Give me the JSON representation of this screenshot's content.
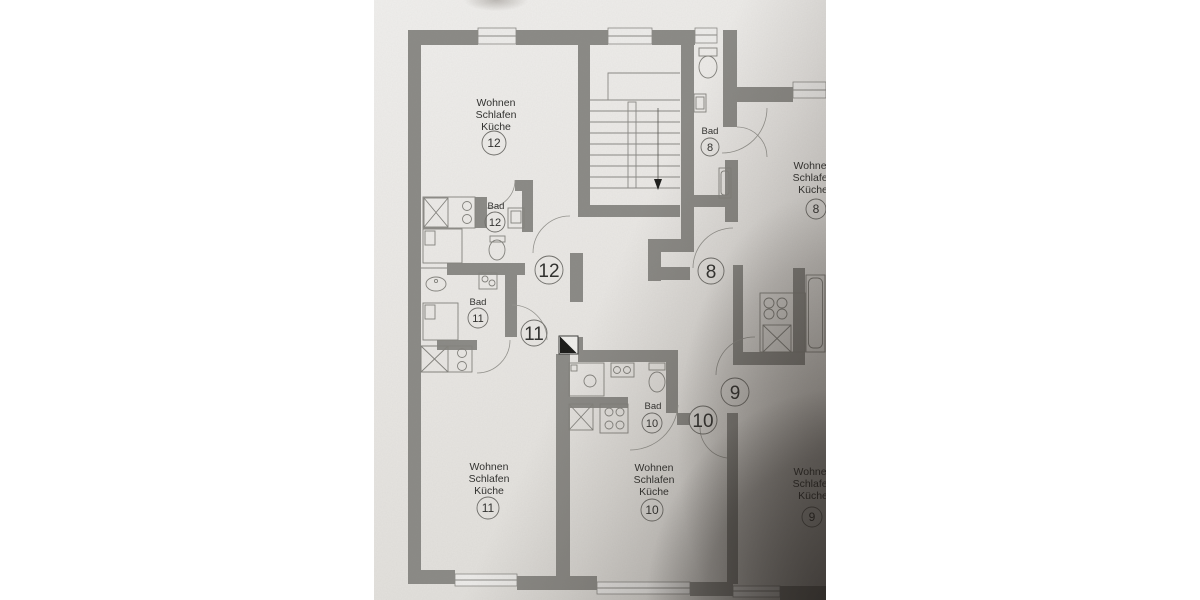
{
  "labels": {
    "apt12": {
      "line1": "Wohnen",
      "line2": "Schlafen",
      "line3": "Küche",
      "number": "12"
    },
    "apt11": {
      "line1": "Wohnen",
      "line2": "Schlafen",
      "line3": "Küche",
      "number": "11"
    },
    "apt10": {
      "line1": "Wohnen",
      "line2": "Schlafen",
      "line3": "Küche",
      "number": "10"
    },
    "apt9": {
      "line1": "Wohnen",
      "line2": "Schlafen",
      "line3": "Küche",
      "number": "9"
    },
    "apt8": {
      "line1": "Wohnen",
      "line2": "Schlafen",
      "line3": "Küche",
      "number": "8"
    },
    "bad12": {
      "name": "Bad",
      "number": "12"
    },
    "bad11": {
      "name": "Bad",
      "number": "11"
    },
    "bad10": {
      "name": "Bad",
      "number": "10"
    },
    "bad8": {
      "name": "Bad",
      "number": "8"
    },
    "doors": {
      "apt12": "12",
      "apt11": "11",
      "apt10": "10",
      "apt9": "9",
      "apt8": "8"
    }
  },
  "icons": [
    "toilet-icon",
    "sink-icon",
    "stove-icon",
    "shower-icon",
    "bed-icon",
    "washing-machine-icon",
    "chimney-flue-icon",
    "stair-direction-arrow-icon",
    "door-swing-arc",
    "window"
  ],
  "colors": {
    "background": "#ffffff",
    "paper": "#e9e7e4",
    "wall": "#8b8a86",
    "thin_line": "#8a8985",
    "text": "#30302e",
    "shadow": "#2a241f"
  }
}
